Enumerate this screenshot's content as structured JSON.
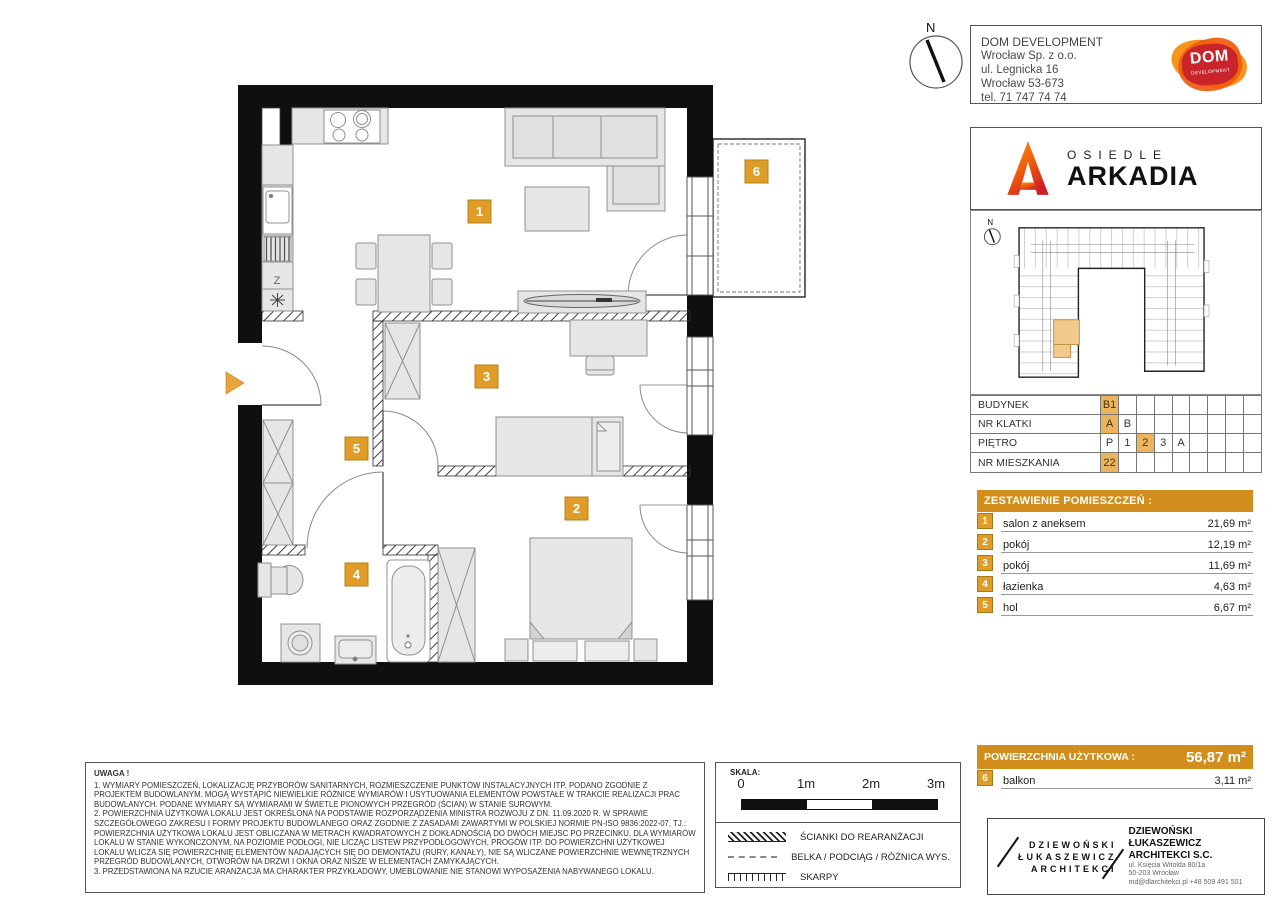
{
  "colors": {
    "accent_orange_bar": "#D28E1C",
    "highlight_cell": "#EBB55F",
    "plan_badge": "#DF9C26",
    "logo_red": "#C9242B",
    "logo_orange": "#F7941D",
    "site_unit_highlight": "#F3CA8E"
  },
  "developer": {
    "name": "DOM DEVELOPMENT",
    "line2": "Wrocław Sp. z o.o.",
    "line3": "ul. Legnicka 16",
    "line4": "Wrocław 53-673",
    "line5": "tel. 71 747 74 74",
    "logo_word": "DOM",
    "logo_sub": "DEVELOPMENT"
  },
  "estate": {
    "prefix": "OSIEDLE",
    "name": "ARKADIA"
  },
  "compass": {
    "label": "N"
  },
  "site_plan": {
    "compass_label": "N"
  },
  "unit_table": {
    "rows": [
      {
        "label": "BUDYNEK",
        "cells": [
          "B1",
          "",
          "",
          "",
          "",
          "",
          "",
          "",
          ""
        ]
      },
      {
        "label": "NR KLATKI",
        "cells": [
          "A",
          "B",
          "",
          "",
          "",
          "",
          "",
          "",
          ""
        ]
      },
      {
        "label": "PIĘTRO",
        "cells": [
          "P",
          "1",
          "2",
          "3",
          "A",
          "",
          "",
          "",
          ""
        ]
      },
      {
        "label": "NR MIESZKANIA",
        "cells": [
          "22",
          "",
          "",
          "",
          "",
          "",
          "",
          "",
          ""
        ]
      }
    ]
  },
  "rooms": {
    "header": "ZESTAWIENIE POMIESZCZEŃ :",
    "items": [
      {
        "no": "1",
        "name": "salon z aneksem",
        "area": "21,69 m²"
      },
      {
        "no": "2",
        "name": "pokój",
        "area": "12,19 m²"
      },
      {
        "no": "3",
        "name": "pokój",
        "area": "11,69 m²"
      },
      {
        "no": "4",
        "name": "łazienka",
        "area": "4,63 m²"
      },
      {
        "no": "5",
        "name": "hol",
        "area": "6,67 m²"
      }
    ]
  },
  "total": {
    "label": "POWIERZCHNIA UŻYTKOWA :",
    "value": "56,87 m²"
  },
  "balcony_row": {
    "no": "6",
    "name": "balkon",
    "area": "3,11 m²"
  },
  "plan": {
    "kitchen_z": "Z"
  },
  "notes": {
    "title": "UWAGA !",
    "p1": "1. WYMIARY POMIESZCZEŃ, LOKALIZACJĘ PRZYBORÓW SANITARNYCH, ROZMIESZCZENIE PUNKTÓW INSTALACYJNYCH ITP. PODANO ZGODNIE Z PROJEKTEM BUDOWLANYM. MOGĄ WYSTĄPIĆ NIEWIELKIE RÓŻNICE WYMIARÓW I USYTUOWANIA ELEMENTÓW POWSTAŁE W TRAKCIE REALIZACJI PRAC BUDOWLANYCH. PODANE WYMIARY SĄ WYMIARAMI W ŚWIETLE PIONOWYCH PRZEGRÓD (ŚCIAN) W STANIE SUROWYM.",
    "p2": "2. POWIERZCHNIA UŻYTKOWA LOKALU JEST OKREŚLONA NA PODSTAWIE ROZPORZĄDZENIA MINISTRA ROZWOJU Z DN. 11.09.2020 R. W SPRAWIE SZCZEGÓŁOWEGO ZAKRESU I FORMY PROJEKTU BUDOWLANEGO ORAZ ZGODNIE Z ZASADAMI ZAWARTYMI W POLSKIEJ NORMIE PN-ISO 9836:2022-07, TJ.: POWIERZCHNIA UŻYTKOWA LOKALU JEST OBLICZANA W METRACH KWADRATOWYCH Z DOKŁADNOŚCIĄ DO DWÓCH MIEJSC PO PRZECINKU, DLA WYMIARÓW LOKALU W STANIE WYKOŃCZONYM, NA POZIOMIE PODŁOGI, NIE LICZĄC LISTEW PRZYPODŁOGOWYCH, PROGÓW ITP. DO POWIERZCHNI UŻYTKOWEJ LOKALU WLICZA SIĘ POWIERZCHNIĘ ELEMENTÓW NADAJĄCYCH SIĘ DO DEMONTAŻU (RURY, KANAŁY), NIE SĄ WLICZANE POWIERZCHNIE WEWNĘTRZNYCH PRZEGRÓD BUDOWLANYCH, OTWORÓW NA DRZWI I OKNA ORAZ NISZE W ELEMENTACH ZAMYKAJĄCYCH.",
    "p3": "3. PRZEDSTAWIONA NA RZUCIE ARANŻACJA MA CHARAKTER PRZYKŁADOWY, UMEBLOWANIE NIE STANOWI WYPOSAŻENIA NABYWANEGO LOKALU."
  },
  "scalebar": {
    "label": "SKALA:",
    "ticks": [
      "0",
      "1m",
      "2m",
      "3m"
    ]
  },
  "legend": {
    "items": [
      {
        "label": "ŚCIANKI DO REARANŻACJI"
      },
      {
        "label": "BELKA / PODCIĄG / RÓŻNICA WYS."
      },
      {
        "label": "SKARPY"
      }
    ]
  },
  "architect": {
    "stencil1": "DZIEWOŃSKI",
    "stencil2": "ŁUKASZEWICZ",
    "stencil3": "ARCHITEKCI",
    "name1": "DZIEWOŃSKI ŁUKASZEWICZ",
    "name2": "ARCHITEKCI S.C.",
    "addr1": "ul. Księcia Witolda 80/1a",
    "addr2": "50-203 Wrocław",
    "addr3": "md@dlarchitekci.pl  +48 509 491 501"
  }
}
